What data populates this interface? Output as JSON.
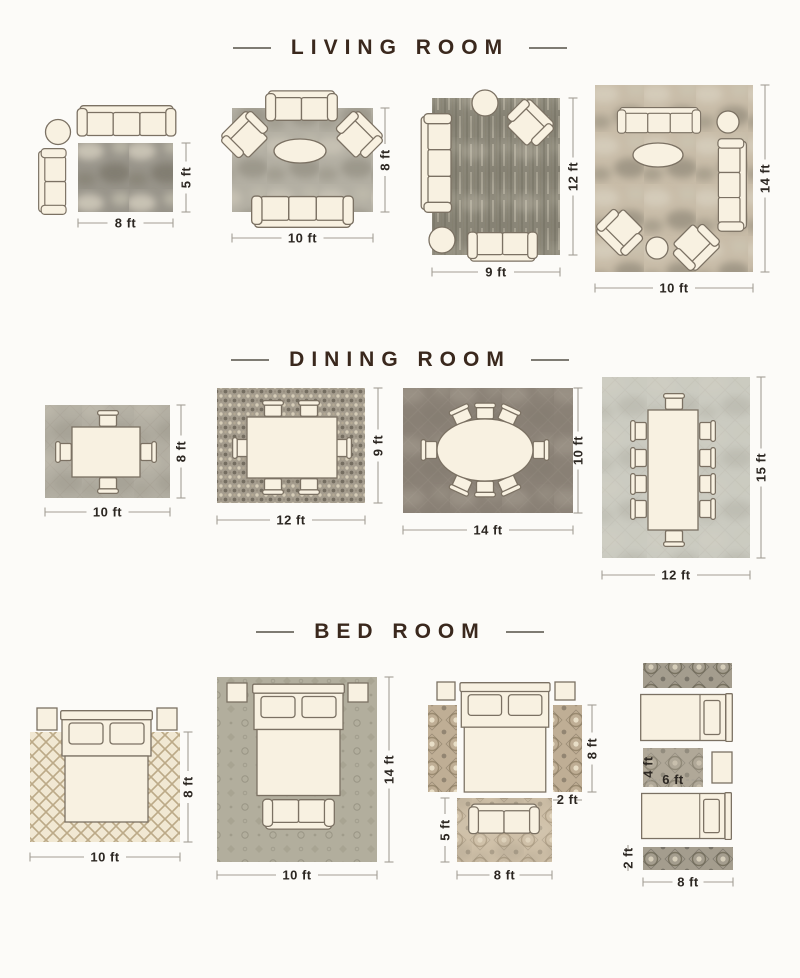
{
  "palette": {
    "page_bg": "#fcfbf8",
    "title_color": "#3a281d",
    "dash_color": "#7e7b73",
    "dim_text_color": "#2c2722",
    "dim_line_color": "#a39e95",
    "furniture_fill": "#f8f1e1",
    "furniture_stroke": "#7b7163",
    "rug_living_1": "#98948a",
    "rug_living_2": "#b3afa3",
    "rug_living_3": "#8b8779",
    "rug_living_4": "#c8bca8",
    "rug_dining_1": "#b2aea2",
    "rug_dining_2": "#a59d8e",
    "rug_dining_3": "#8a8176",
    "rug_dining_4": "#cbcbc1",
    "rug_bed_1": "#f1e8d3",
    "rug_bed_2": "#b2ae9d",
    "rug_bed_3_runner": "#bfae95",
    "rug_bed_3_foot": "#cfc0a8",
    "rug_bed_4_runner": "#a49d8e",
    "rug_bed_4_mid": "#b0a898"
  },
  "sections": [
    {
      "id": "living-room",
      "title": "LIVING ROOM",
      "layouts": [
        {
          "name": "sofa-with-chaise-rug-8x5",
          "labels": {
            "w": "8 ft",
            "h": "5 ft"
          }
        },
        {
          "name": "sofa-two-chairs-rug-10x8",
          "labels": {
            "w": "10 ft",
            "h": "8 ft"
          }
        },
        {
          "name": "two-sofas-one-chair-rug-9x12",
          "labels": {
            "w": "9 ft",
            "h": "12 ft"
          }
        },
        {
          "name": "two-sofas-two-chairs-rug-10x14",
          "labels": {
            "w": "10 ft",
            "h": "14 ft"
          }
        }
      ]
    },
    {
      "id": "dining-room",
      "title": "DINING ROOM",
      "layouts": [
        {
          "name": "square-table-4-chairs-rug-10x8",
          "labels": {
            "w": "10 ft",
            "h": "8 ft"
          }
        },
        {
          "name": "rect-table-6-chairs-rug-12x9",
          "labels": {
            "w": "12 ft",
            "h": "9 ft"
          }
        },
        {
          "name": "oval-table-8-chairs-rug-14x10",
          "labels": {
            "w": "14 ft",
            "h": "10 ft"
          }
        },
        {
          "name": "long-table-10-chairs-rug-12x15",
          "labels": {
            "w": "12 ft",
            "h": "15 ft"
          }
        }
      ]
    },
    {
      "id": "bed-room",
      "title": "BED ROOM",
      "layouts": [
        {
          "name": "bed-on-rug-10x8",
          "labels": {
            "w": "10 ft",
            "h": "8 ft"
          }
        },
        {
          "name": "bed-bench-rug-10x14",
          "labels": {
            "w": "10 ft",
            "h": "14 ft"
          }
        },
        {
          "name": "bed-side-runners-foot-rug",
          "labels": {
            "runner_length": "8 ft",
            "runner_width": "2 ft",
            "foot_rug_height": "5 ft",
            "foot_rug_width": "8 ft"
          }
        },
        {
          "name": "twin-beds-runners-center-rug",
          "labels": {
            "mid_rug_height": "4 ft",
            "mid_rug_width": "6 ft",
            "runner_width": "2 ft",
            "runner_length": "8 ft"
          }
        }
      ]
    }
  ]
}
